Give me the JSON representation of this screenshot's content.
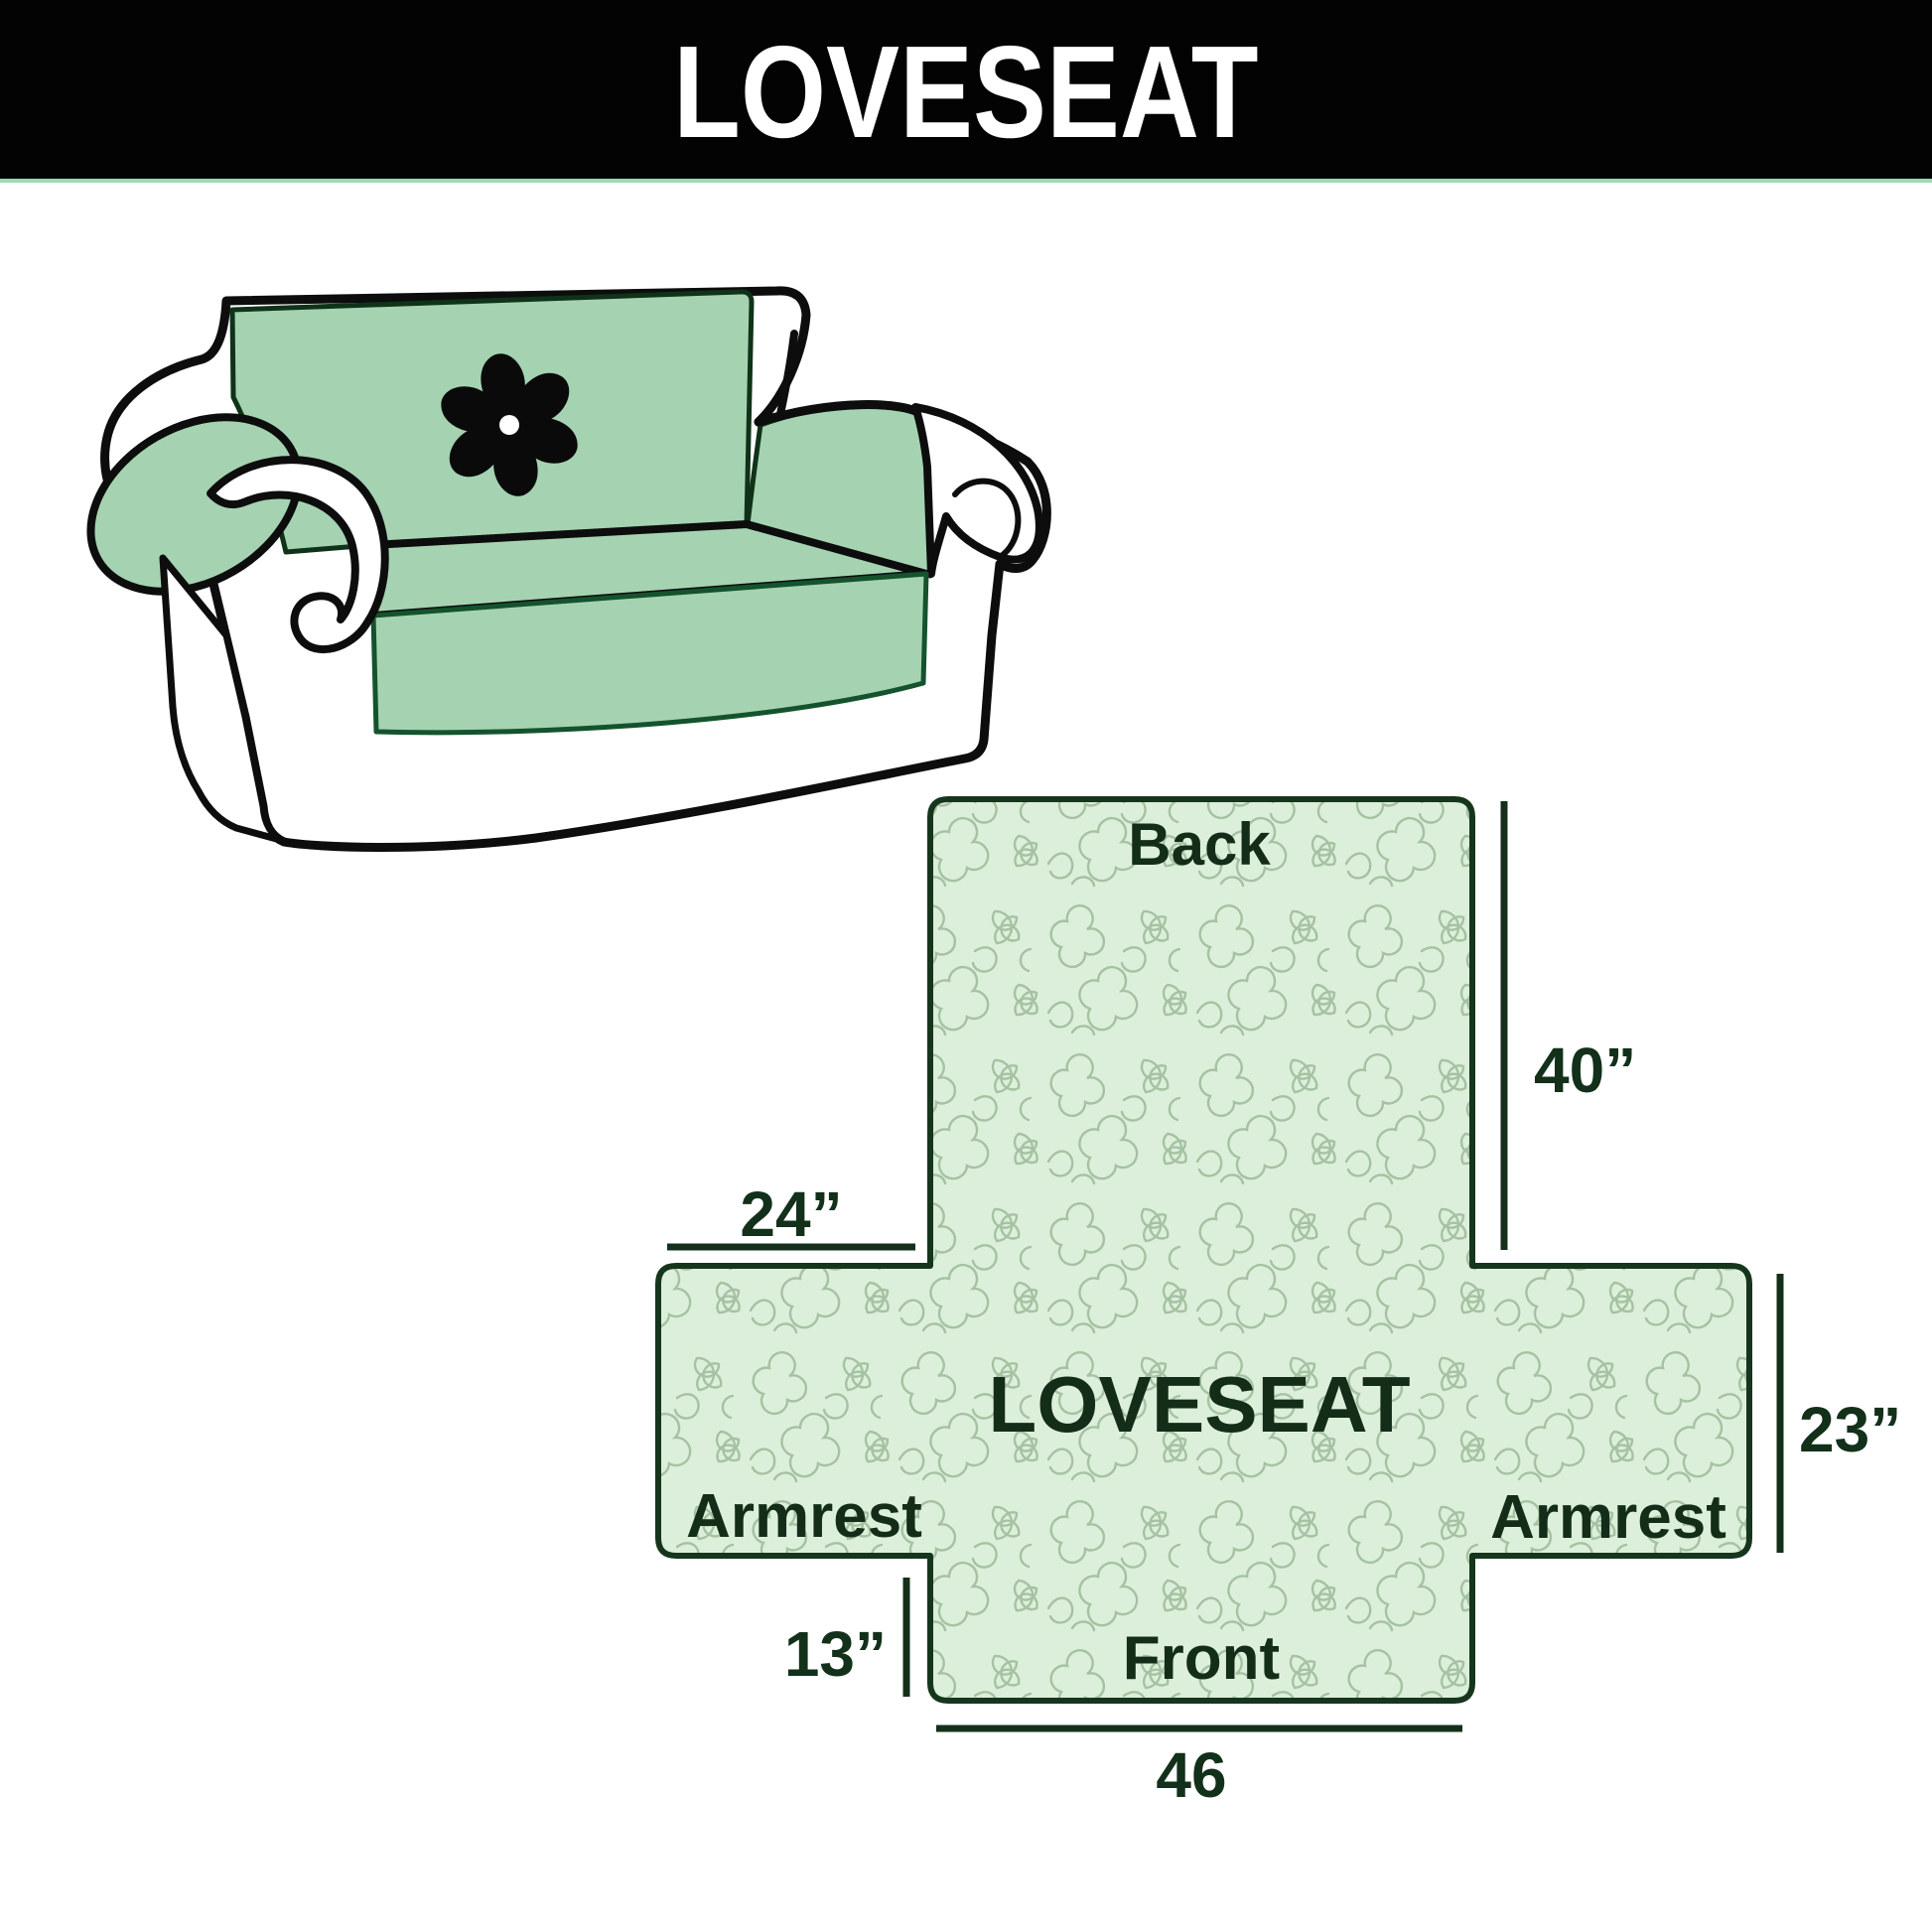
{
  "header": {
    "title": "LOVESEAT",
    "bar_color": "#030303",
    "text_color": "#ffffff",
    "underline_color": "#9ed8b7"
  },
  "illustration": {
    "description": "loveseat sofa with quilted green furniture cover draped over back, seat and armrests",
    "cover_color": "#a5d3b2",
    "body_color": "#ffffff",
    "outline_color": "#0d0d0d",
    "logo": "pinwheel-logo",
    "logo_color": "#0a0a0a"
  },
  "diagram": {
    "product_label": "LOVESEAT",
    "sections": {
      "back": "Back",
      "armrest_left": "Armrest",
      "armrest_right": "Armrest",
      "front": "Front"
    },
    "dimensions": {
      "back_height": "40”",
      "armrest_top_width": "24”",
      "armrest_side_height": "23”",
      "front_flap_height": "13”",
      "front_width": "46"
    },
    "measurements_inches": {
      "back_height": 40,
      "armrest_top_width": 24,
      "armrest_side_height": 23,
      "front_flap_height": 13,
      "front_width": 46
    },
    "colors": {
      "fill": "#dcefda",
      "pattern_stroke": "#a5c2a2",
      "outline": "#16351d",
      "text": "#12301a"
    }
  }
}
